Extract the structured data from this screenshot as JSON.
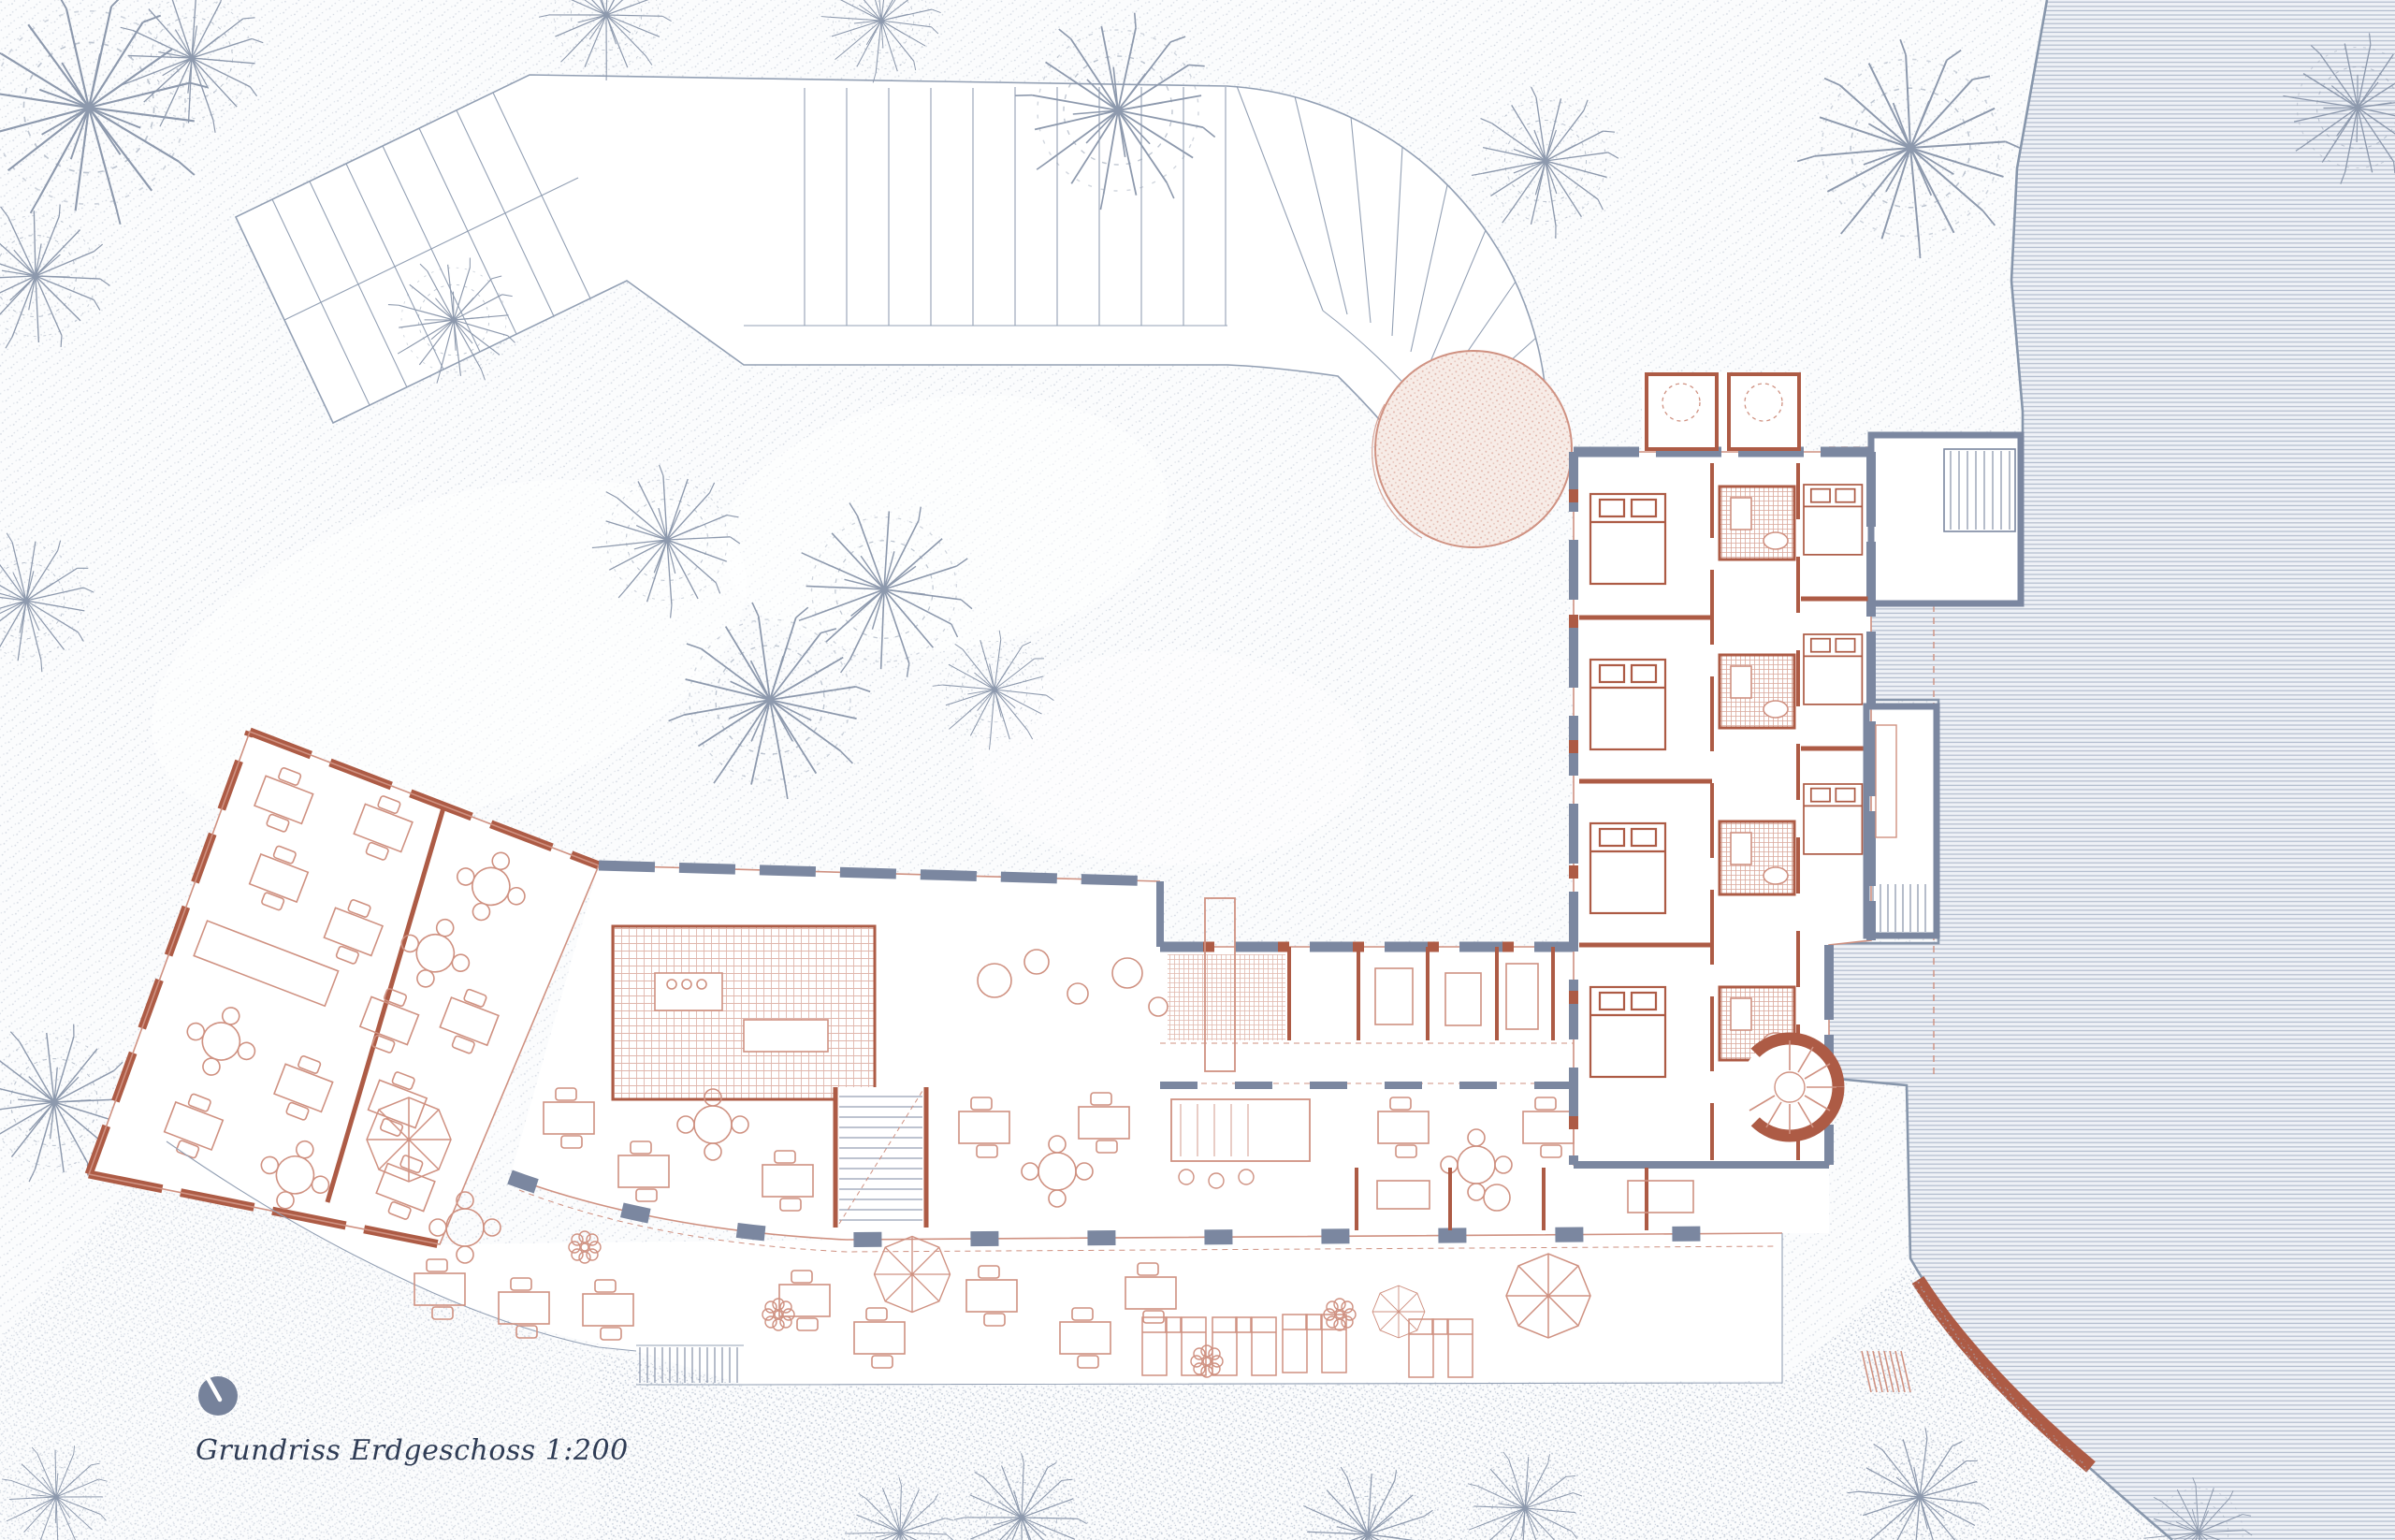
{
  "caption": {
    "text": "Grundriss Erdgeschoss 1:200"
  },
  "plan_info": {
    "drawing_type": "Grundriss",
    "floor": "Erdgeschoss",
    "scale": "1:200"
  },
  "icons": {
    "north_indicator": "north-arrow-icon"
  },
  "colors": {
    "paper": "#fbfcfd",
    "stipple": "#a9b4c6",
    "line_gray": "#93a0b4",
    "wall_slate": "#7b87a0",
    "wall_terracotta": "#ad5b45",
    "terracotta_light": "#cf9181",
    "pink_fill": "#f7ece7",
    "water_fill": "#eef1f6",
    "water_line": "#a9b4c7",
    "ink": "#2f3c55",
    "north_fill": "#76829b",
    "seawall": "#ad5b45"
  }
}
